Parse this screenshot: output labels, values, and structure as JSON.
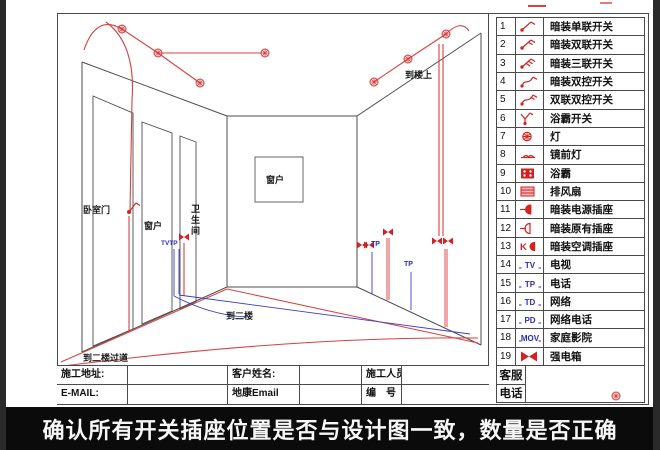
{
  "colors": {
    "symbol_red": "#d42222",
    "symbol_blue": "#2a2acc",
    "wire_red": "#d94040",
    "wire_pink": "#f0a6a6",
    "wall_gray": "#4d4d4d",
    "caption_bg": "#0b0b0b"
  },
  "caption": {
    "text": "确认所有开关插座位置是否与设计图一致，数量是否正确"
  },
  "legend": {
    "items": [
      {
        "num": "1",
        "symbol": "switch-single",
        "label": "暗装单联开关"
      },
      {
        "num": "2",
        "symbol": "switch-double",
        "label": "暗装双联开关"
      },
      {
        "num": "3",
        "symbol": "switch-triple",
        "label": "暗装三联开关"
      },
      {
        "num": "4",
        "symbol": "switch-two-way",
        "label": "暗装双控开关"
      },
      {
        "num": "5",
        "symbol": "switch-double-two-way",
        "label": "双联双控开关"
      },
      {
        "num": "6",
        "symbol": "bath-heater-switch",
        "label": "浴霸开关"
      },
      {
        "num": "7",
        "symbol": "lamp",
        "label": "灯"
      },
      {
        "num": "8",
        "symbol": "mirror-lamp",
        "label": "镜前灯"
      },
      {
        "num": "9",
        "symbol": "bath-heater",
        "label": "浴霸"
      },
      {
        "num": "10",
        "symbol": "exhaust-fan",
        "label": "排风扇"
      },
      {
        "num": "11",
        "symbol": "power-socket",
        "label": "暗装电源插座"
      },
      {
        "num": "12",
        "symbol": "existing-socket",
        "label": "暗装原有插座"
      },
      {
        "num": "13",
        "symbol": "ac-socket",
        "label": "暗装空调插座",
        "text": "K"
      },
      {
        "num": "14",
        "symbol": "text-symbol",
        "label": "电视",
        "text": "TV"
      },
      {
        "num": "15",
        "symbol": "text-symbol",
        "label": "电话",
        "text": "TP"
      },
      {
        "num": "16",
        "symbol": "text-symbol",
        "label": "网络",
        "text": "TD"
      },
      {
        "num": "17",
        "symbol": "text-symbol",
        "label": "网络电话",
        "text": "PD"
      },
      {
        "num": "18",
        "symbol": "text-symbol",
        "label": "家庭影院",
        "text": "MOV"
      },
      {
        "num": "19",
        "symbol": "power-box",
        "label": "强电箱"
      }
    ],
    "footer": {
      "row1": "客服",
      "row2": "电话"
    }
  },
  "title_block": {
    "address_label": "施工地址:",
    "email_label": "E-MAIL:",
    "customer_label": "客户姓名:",
    "customer_email_label": "地康Email",
    "staff_label": "施工人员",
    "number_label": "编　号"
  },
  "drawing": {
    "labels": {
      "bedroom_door": "卧室门",
      "left_window": "窗户",
      "bathroom": "卫生间",
      "back_window": "窗户",
      "to_upstairs": "到楼上",
      "to_second_floor": "到二楼",
      "to_second_floor_corridor": "到二楼过道",
      "tvtp": "TVTP",
      "tp_right_1": "TP",
      "tp_right_2": "TP"
    }
  }
}
